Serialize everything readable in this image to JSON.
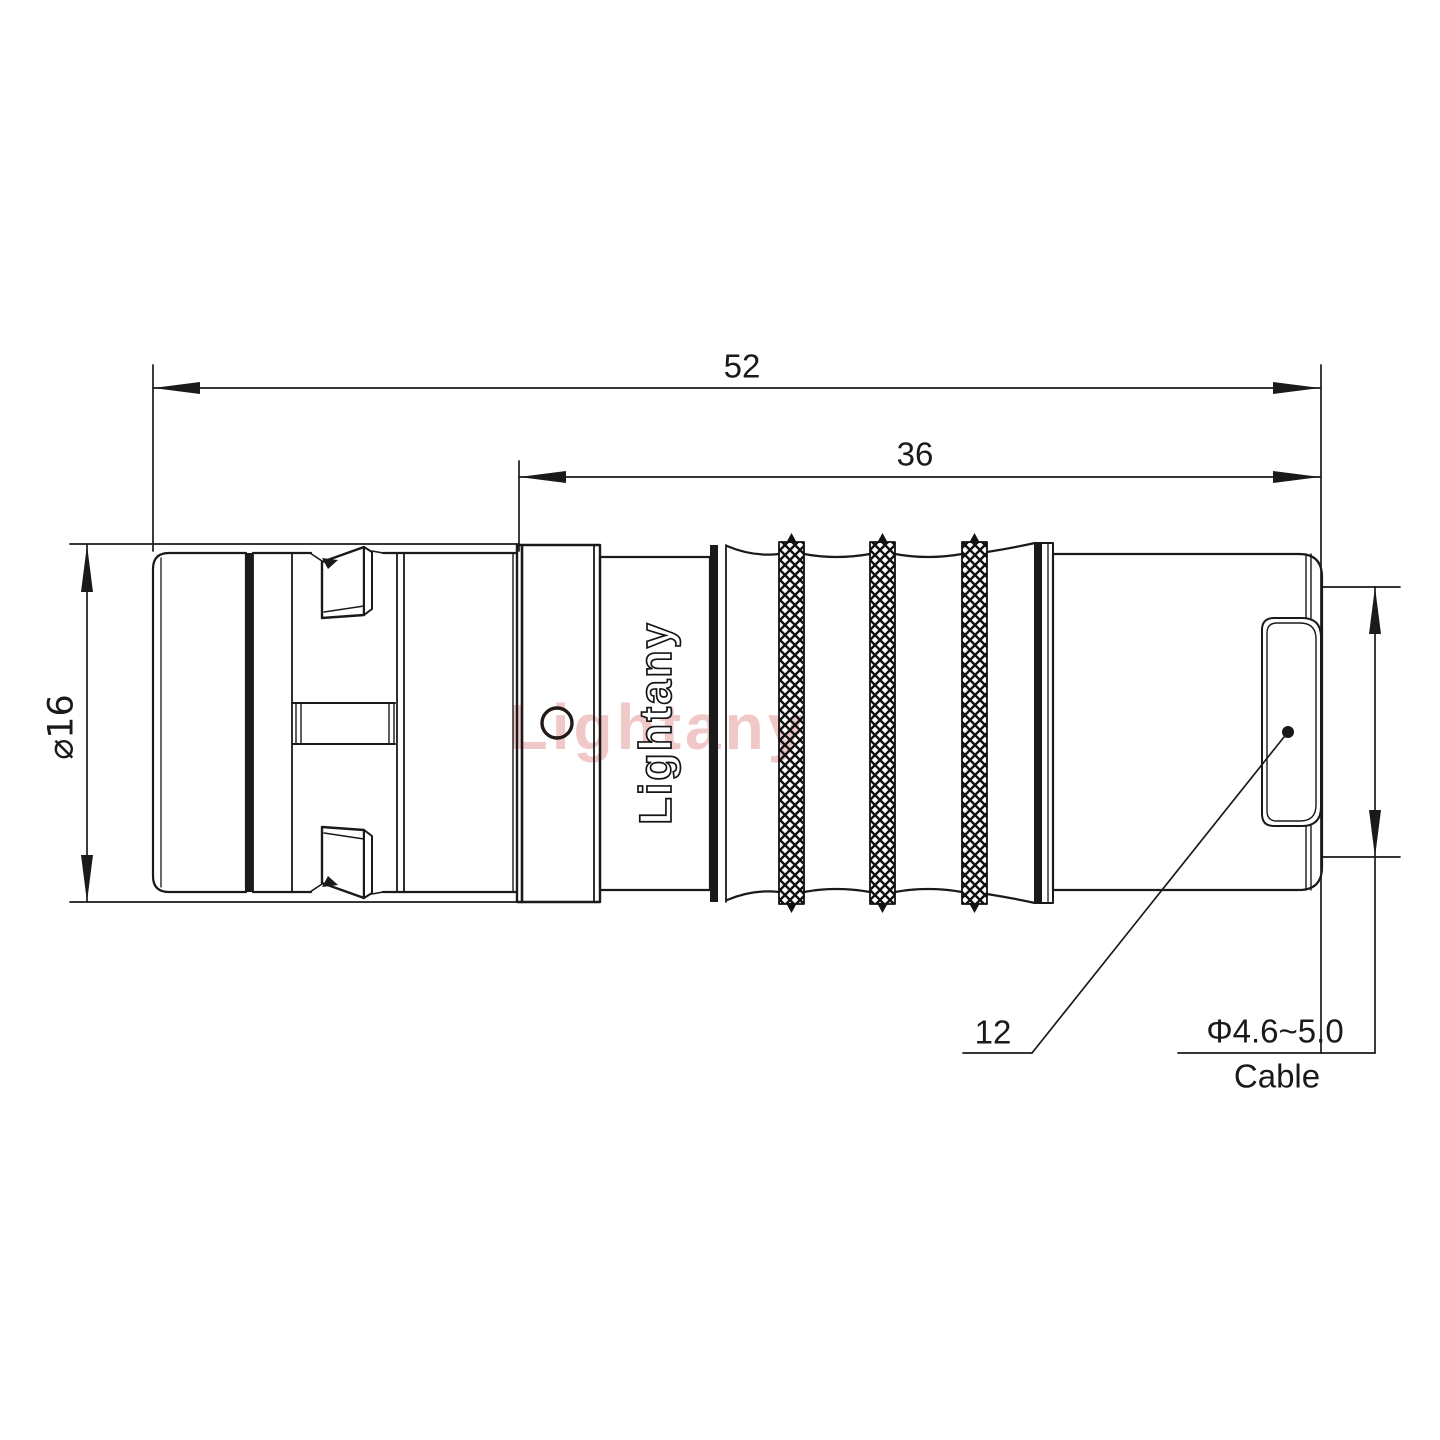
{
  "drawing": {
    "type": "connector-technical-drawing",
    "dimensions": {
      "overall_length": "52",
      "rear_section_length": "36",
      "body_diameter": "⌀16",
      "rear_diameter": "12",
      "cable_spec": "Φ4.6~5.0",
      "cable_word": "Cable"
    },
    "branding": {
      "engraved_text": "Lightany",
      "watermark_text": "Lightany"
    },
    "colors": {
      "line": "#1a1a1a",
      "watermark": "rgba(206,73,73,0.30)",
      "hole_ring": "#221a18"
    }
  }
}
